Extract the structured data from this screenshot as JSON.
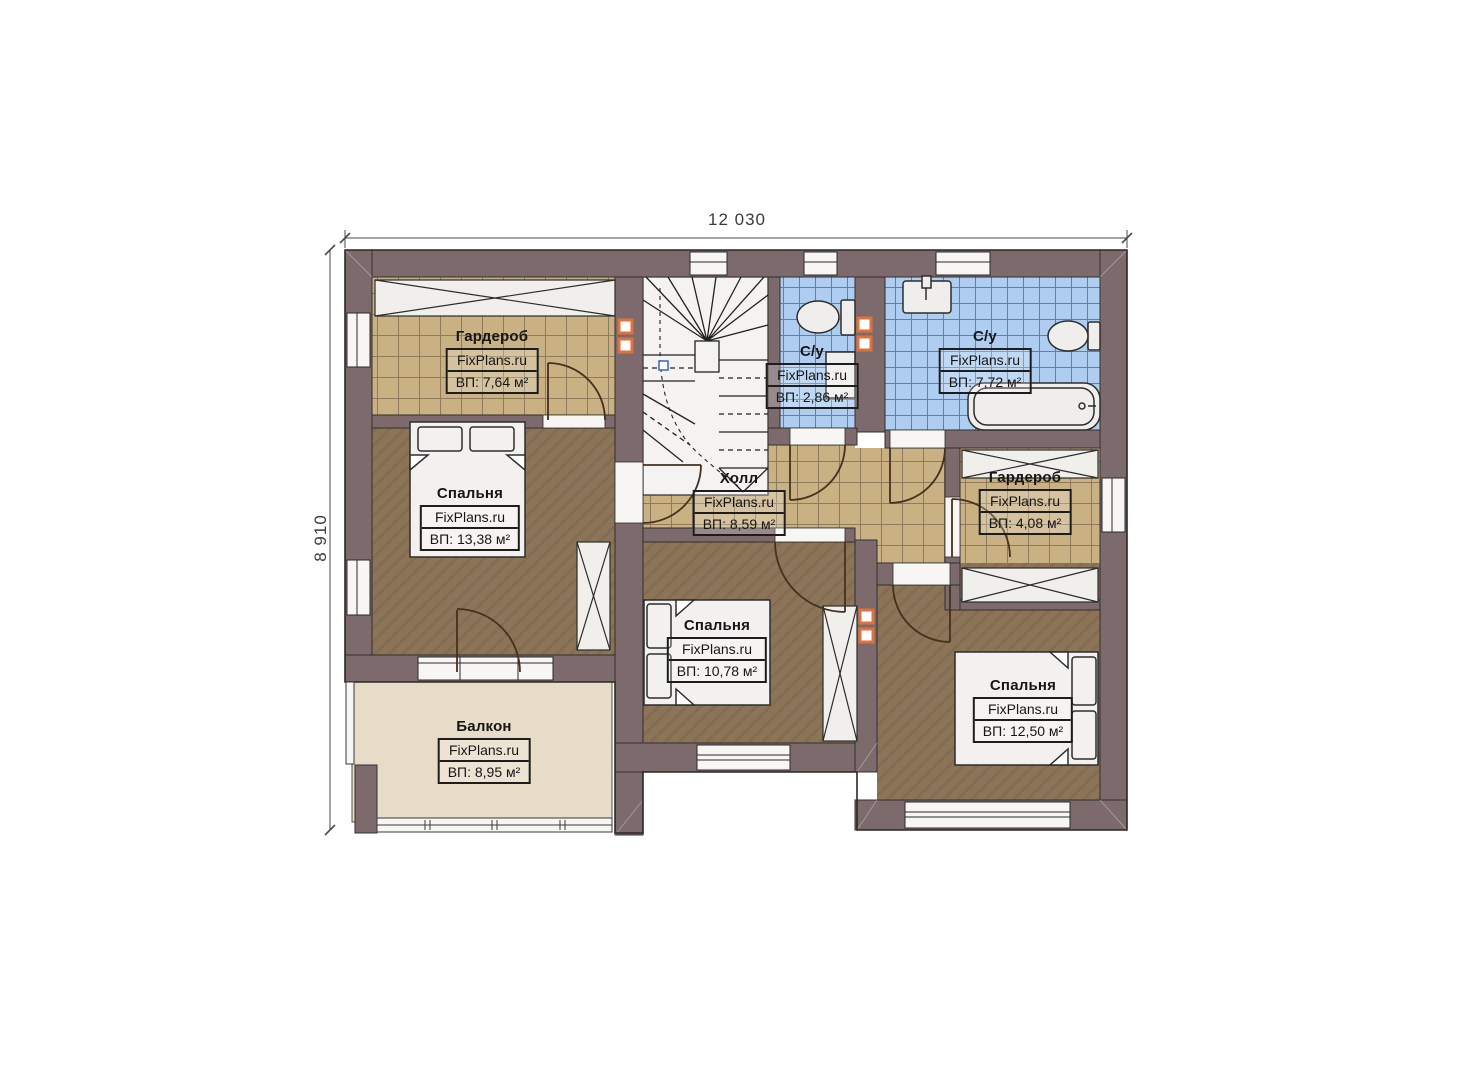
{
  "plan": {
    "dimensions": {
      "width": "12 030",
      "height": "8 910"
    },
    "brand": "FixPlans.ru",
    "rooms": [
      {
        "id": "wardrobe-top",
        "name": "Гардероб",
        "brand": "FixPlans.ru",
        "area": "ВП: 7,64 м²"
      },
      {
        "id": "bedroom-left",
        "name": "Спальня",
        "brand": "FixPlans.ru",
        "area": "ВП: 13,38 м²"
      },
      {
        "id": "hall",
        "name": "Холл",
        "brand": "FixPlans.ru",
        "area": "ВП: 8,59 м²"
      },
      {
        "id": "bathroom-small",
        "name": "С/у",
        "brand": "FixPlans.ru",
        "area": "ВП: 2,86 м²"
      },
      {
        "id": "bathroom-large",
        "name": "С/у",
        "brand": "FixPlans.ru",
        "area": "ВП: 7,72 м²"
      },
      {
        "id": "wardrobe-right",
        "name": "Гардероб",
        "brand": "FixPlans.ru",
        "area": "ВП: 4,08 м²"
      },
      {
        "id": "bedroom-middle",
        "name": "Спальня",
        "brand": "FixPlans.ru",
        "area": "ВП: 10,78 м²"
      },
      {
        "id": "bedroom-right",
        "name": "Спальня",
        "brand": "FixPlans.ru",
        "area": "ВП: 12,50 м²"
      },
      {
        "id": "balcony",
        "name": "Балкон",
        "brand": "FixPlans.ru",
        "area": "ВП: 8,95 м²"
      }
    ],
    "colors": {
      "wall": "#7c6a6c",
      "tile_beige": "#c9b183",
      "tile_blue": "#aecdf0",
      "floor_brown": "#8b7458",
      "balcony_floor": "#e7dcc7",
      "vent_accent": "#e0713c"
    }
  }
}
